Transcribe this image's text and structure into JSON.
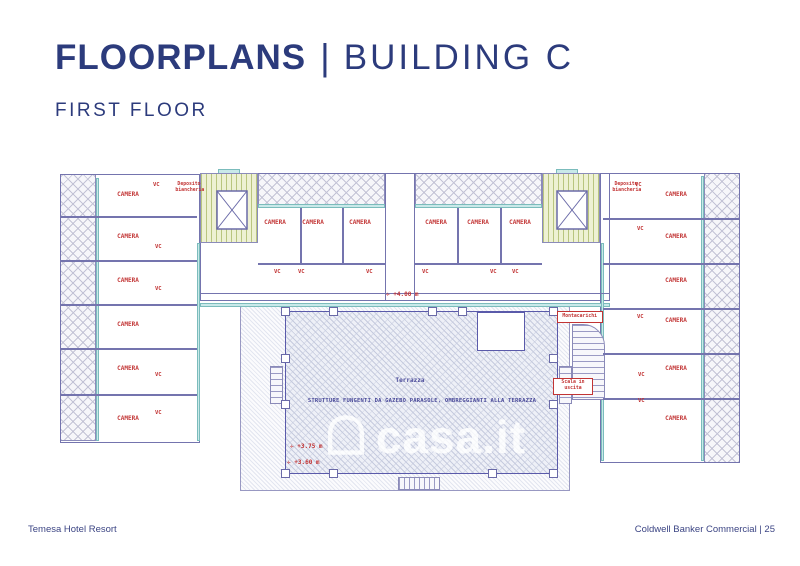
{
  "page": {
    "title_main": "FLOORPLANS",
    "title_separator": "|",
    "title_building": "BUILDING C",
    "subtitle": "FIRST FLOOR"
  },
  "footer": {
    "left_text": "Temesa Hotel Resort",
    "right_text": "Coldwell Banker Commercial | 25"
  },
  "watermark": {
    "text": "casa.it",
    "icon": "house-outline-icon"
  },
  "plan": {
    "labels": {
      "camera": "CAMERA",
      "vc": "VC",
      "deposito": "Deposito biancheria",
      "montacarichi": "Montacarichi",
      "scala": "Scala in uscita",
      "terrazza": "Terrazza",
      "caption": "STRUTTURE FUNGENTI DA GAZEBO PARASOLE, OMBREGGIANTI ALLA TERRAZZA",
      "elev_icon": "✛",
      "elev_top": "+4.00 m",
      "elev_mid": "+3.75 m",
      "elev_low": "+3.60 m"
    },
    "colors": {
      "title_navy": "#2c3b7c",
      "wall_purple": "#7474ae",
      "label_red": "#c23434",
      "window_cyan": "#c9e9e9",
      "stair_green": "#eef1d3",
      "hatch_gray": "#c3c3d6"
    }
  }
}
